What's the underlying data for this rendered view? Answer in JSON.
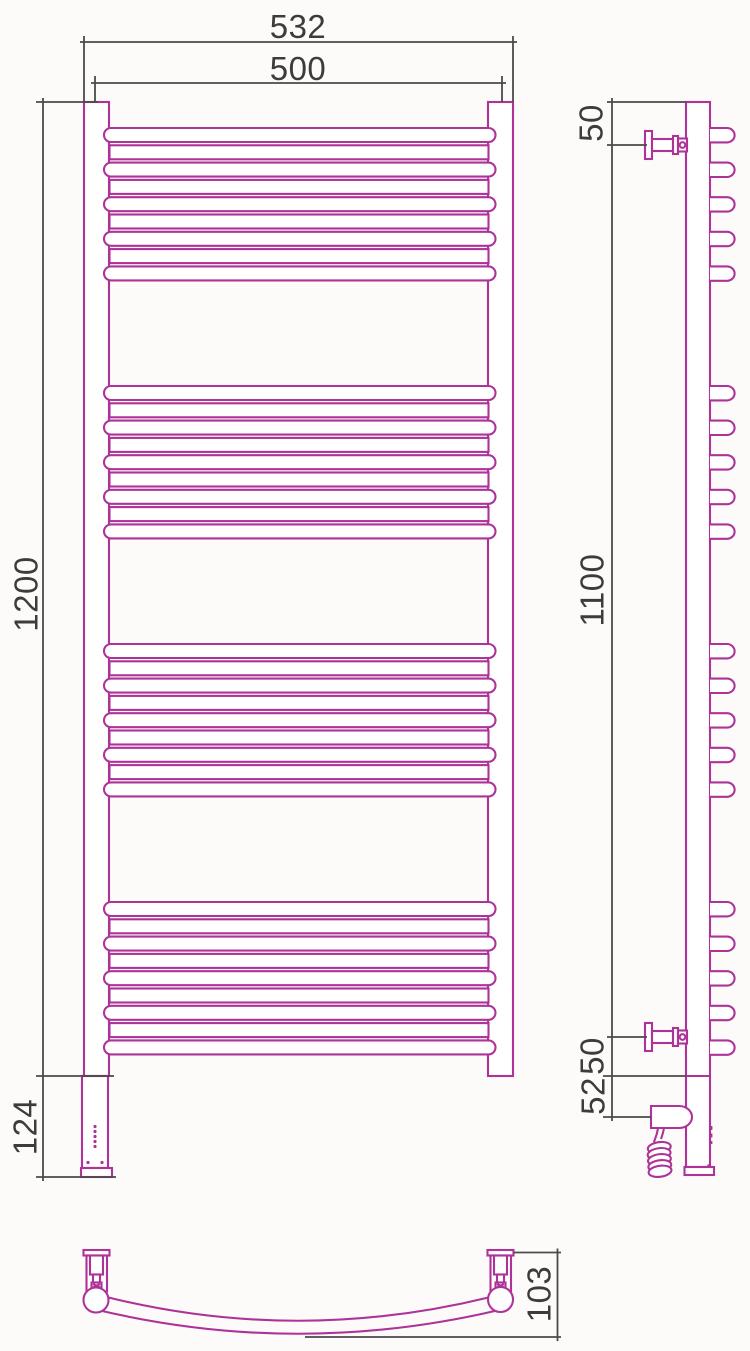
{
  "drawing": {
    "type": "technical-drawing",
    "subject": "curved ladder towel radiator with electric heating element, three orthographic views"
  },
  "structure": {
    "rung_groups": 4,
    "curved_rungs_per_group": 5,
    "straight_rungs_per_group": 4
  },
  "dimensions": {
    "front": {
      "overall_width": "532",
      "rail_width": "500",
      "overall_height": "1200",
      "heater_section_height": "124"
    },
    "side": {
      "top_bracket_offset": "50",
      "bracket_span": "1100",
      "bottom_bracket_offset": "50",
      "heater_unit_offset": "52"
    },
    "bottom": {
      "bow_depth": "103"
    }
  },
  "colors": {
    "product_line": "#ae3399",
    "dimension_line": "#4b4b4b",
    "text": "#3c3c3c",
    "background": "#fcfbfa"
  }
}
